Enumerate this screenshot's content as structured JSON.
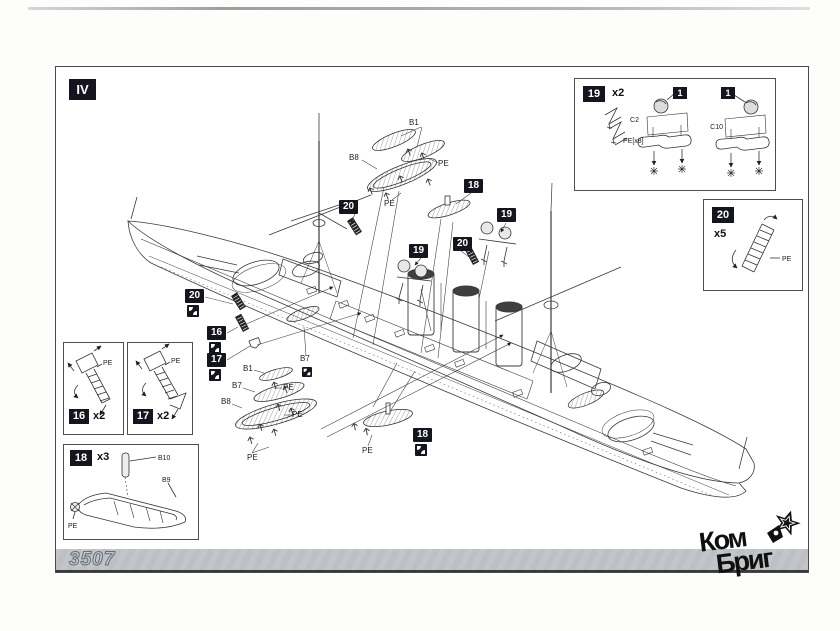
{
  "page": {
    "step_label": "IV",
    "product_code": "3507"
  },
  "logo": {
    "line1": "Ком",
    "line2": "Бриг"
  },
  "boxes": {
    "b19": {
      "num": "19",
      "qty": "x2",
      "pe": "PE[x8]",
      "left_part": "C2",
      "right_part": "C10",
      "callout_left": "1",
      "callout_right": "1"
    },
    "b20": {
      "num": "20",
      "qty": "x5",
      "pe": "PE"
    },
    "b16": {
      "num": "16",
      "qty": "x2",
      "pe": "PE"
    },
    "b17": {
      "num": "17",
      "qty": "x2",
      "pe": "PE"
    },
    "b18": {
      "num": "18",
      "qty": "x3",
      "mast": "B10",
      "hull": "B9",
      "pe": "PE"
    }
  },
  "callouts": {
    "fore_ladder": "20",
    "launch_top": "18",
    "searchlight_right": "19",
    "searchlight_left": "19",
    "mid_ladder": "20",
    "bow_ladder": "20",
    "ladder16": "16",
    "ladder17": "17",
    "boat_bottom": "18"
  },
  "labels": {
    "b1_top": "B1",
    "b8_top": "B8",
    "pe_top_right": "PE",
    "pe_top_mid": "PE",
    "b1_left": "B1",
    "b7_left": "B7",
    "b8_left": "B8",
    "pe_left_upper": "PE",
    "pe_left_mid": "PE",
    "pe_left_lower": "PE",
    "b7_deck": "B7",
    "pe_boat_bottom": "PE"
  }
}
